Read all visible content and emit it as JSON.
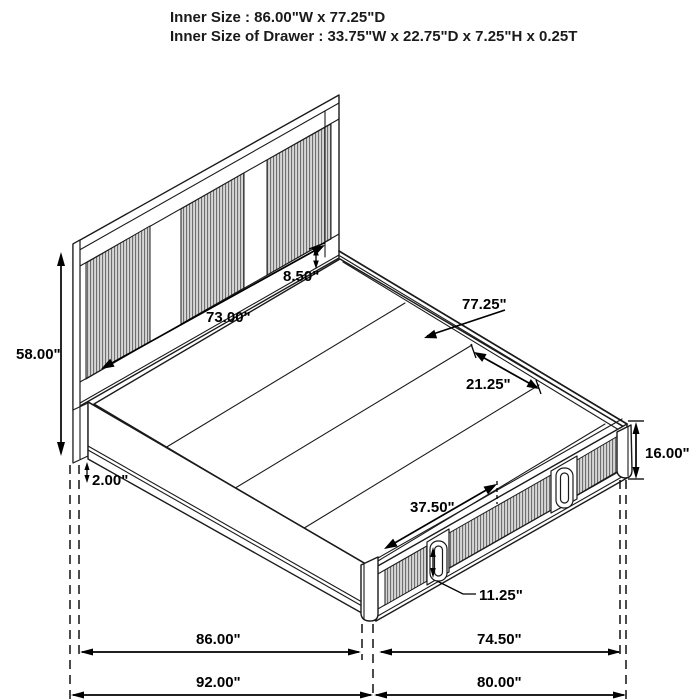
{
  "title": {
    "line1": "Inner Size : 86.00\"W x 77.25\"D",
    "line2": "Inner Size of Drawer : 33.75\"W x 22.75\"D x 7.25\"H x 0.25T"
  },
  "dimensions": {
    "headboard_height": "58.00\"",
    "headboard_inner_width": "73.00\"",
    "headboard_rail_height": "8.50\"",
    "inner_depth": "77.25\"",
    "slat_section_depth": "21.25\"",
    "footboard_height": "16.00\"",
    "floor_clearance": "2.00\"",
    "drawer_front_width": "37.50\"",
    "drawer_front_height": "11.25\"",
    "inner_width": "86.00\"",
    "foot_inner_width": "74.50\"",
    "overall_width": "92.00\"",
    "overall_depth": "80.00\""
  },
  "colors": {
    "line": "#1a1a1a",
    "dim": "#000000",
    "rib-light": "#d7d7d7",
    "rib-dark": "#6f6f6f",
    "bg": "#ffffff"
  }
}
